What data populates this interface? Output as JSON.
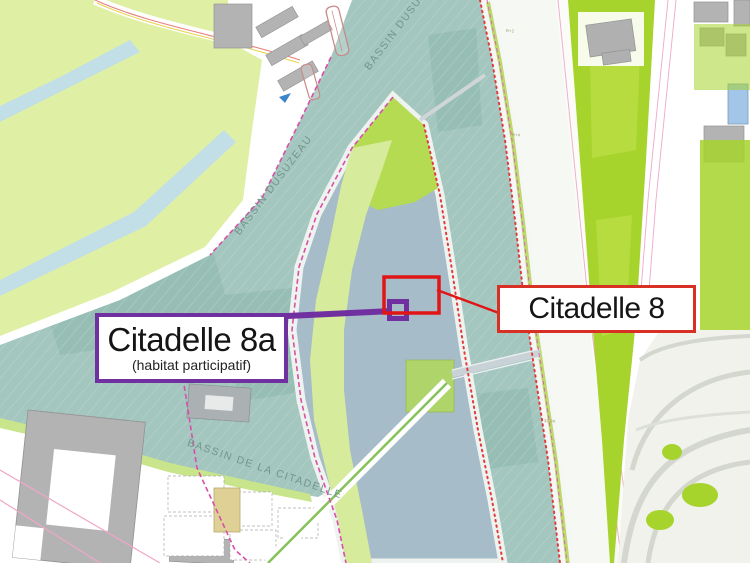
{
  "annotations": {
    "citadelle_8a": {
      "title": "Citadelle 8a",
      "subtitle": "(habitat participatif)",
      "accent_color": "#7030A0"
    },
    "citadelle_8": {
      "title": "Citadelle 8",
      "accent_color": "#D93025"
    }
  },
  "map": {
    "water_labels": {
      "dusuzeau": "BASSIN DUSUZEAU",
      "citadelle": "BASSIN DE LA CITADELLE"
    },
    "parcel_labels": [
      "R+2",
      "R+4",
      "R+8",
      "32 PA"
    ],
    "colors": {
      "water": "#A3C6BE",
      "park_green": "#DFF0A4",
      "bright_green": "#A6D32C",
      "tree_green": "#4C7020",
      "tree_teal": "#3E7465",
      "building_gray": "#B3B3B3",
      "street_blue": "#A6BCC9",
      "moat_blue": "#C2DEE6",
      "boundary_pink": "#D94FA8",
      "quay_red": "#E23A3A",
      "boat_red": "#E06060",
      "target_red": "#E01515",
      "target_purple": "#7030A0"
    }
  }
}
